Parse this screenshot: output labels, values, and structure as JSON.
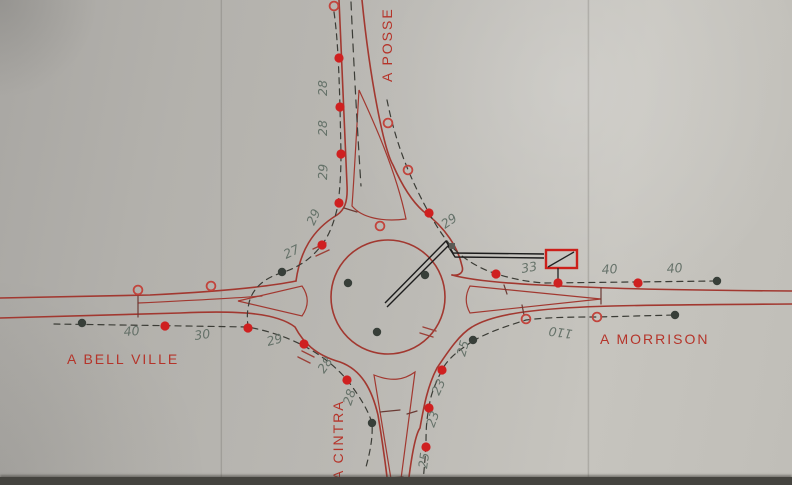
{
  "drawing_title": "hand-drawn roundabout traffic survey plan",
  "roads": [
    {
      "id": "top",
      "label": "A POSSE"
    },
    {
      "id": "left",
      "label": "A BELL VILLE"
    },
    {
      "id": "right",
      "label": "A MORRISON"
    },
    {
      "id": "bottom",
      "label": "A CINTRA"
    }
  ],
  "measurements": [
    {
      "value": "28",
      "x": 327,
      "y": 96,
      "rotate": -90
    },
    {
      "value": "28",
      "x": 327,
      "y": 136,
      "rotate": -90
    },
    {
      "value": "29",
      "x": 327,
      "y": 180,
      "rotate": -88
    },
    {
      "value": "29",
      "x": 314,
      "y": 226,
      "rotate": -65
    },
    {
      "value": "27",
      "x": 286,
      "y": 259,
      "rotate": -25
    },
    {
      "value": "29",
      "x": 445,
      "y": 229,
      "rotate": -35
    },
    {
      "value": "33",
      "x": 522,
      "y": 273,
      "rotate": -10
    },
    {
      "value": "40",
      "x": 602,
      "y": 274,
      "rotate": -4
    },
    {
      "value": "40",
      "x": 667,
      "y": 273,
      "rotate": -4
    },
    {
      "value": "110",
      "x": 573,
      "y": 330,
      "rotate": 188
    },
    {
      "value": "40",
      "x": 124,
      "y": 336,
      "rotate": -4
    },
    {
      "value": "30",
      "x": 195,
      "y": 340,
      "rotate": -8
    },
    {
      "value": "29",
      "x": 268,
      "y": 346,
      "rotate": -15
    },
    {
      "value": "28",
      "x": 324,
      "y": 374,
      "rotate": -55
    },
    {
      "value": "28",
      "x": 351,
      "y": 406,
      "rotate": -72
    },
    {
      "value": "25",
      "x": 465,
      "y": 357,
      "rotate": -75
    },
    {
      "value": "23",
      "x": 439,
      "y": 396,
      "rotate": -65
    },
    {
      "value": "23",
      "x": 434,
      "y": 428,
      "rotate": -70
    },
    {
      "value": "25",
      "x": 427,
      "y": 469,
      "rotate": -82
    }
  ],
  "markers": {
    "red_dots": [
      [
        339,
        58
      ],
      [
        340,
        107
      ],
      [
        341,
        154
      ],
      [
        339,
        203
      ],
      [
        322,
        245
      ],
      [
        429,
        213
      ],
      [
        496,
        274
      ],
      [
        558,
        283
      ],
      [
        638,
        283
      ],
      [
        165,
        326
      ],
      [
        248,
        328
      ],
      [
        304,
        344
      ],
      [
        347,
        380
      ],
      [
        442,
        370
      ],
      [
        429,
        408
      ],
      [
        426,
        447
      ]
    ],
    "dark_dots": [
      [
        82,
        323
      ],
      [
        282,
        272
      ],
      [
        372,
        423
      ],
      [
        473,
        340
      ],
      [
        675,
        315
      ],
      [
        717,
        281
      ],
      [
        348,
        283
      ],
      [
        377,
        332
      ],
      [
        425,
        275
      ]
    ],
    "open_circles": [
      [
        334,
        6
      ],
      [
        388,
        123
      ],
      [
        408,
        170
      ],
      [
        380,
        226
      ],
      [
        138,
        290
      ],
      [
        211,
        286
      ],
      [
        526,
        319
      ],
      [
        597,
        317
      ]
    ],
    "square_dots": [
      [
        452,
        246
      ]
    ]
  },
  "colors": {
    "road_ink": "#a23830",
    "label_red": "#b5342a",
    "pencil": "#5d6b62",
    "red_dot": "#cf2020",
    "dark_dot": "#383f39",
    "open_circle": "#c2443c",
    "leader": "#1c1c1c",
    "sign_box": "#cc1f1a",
    "paper": "#b8b6b1"
  }
}
